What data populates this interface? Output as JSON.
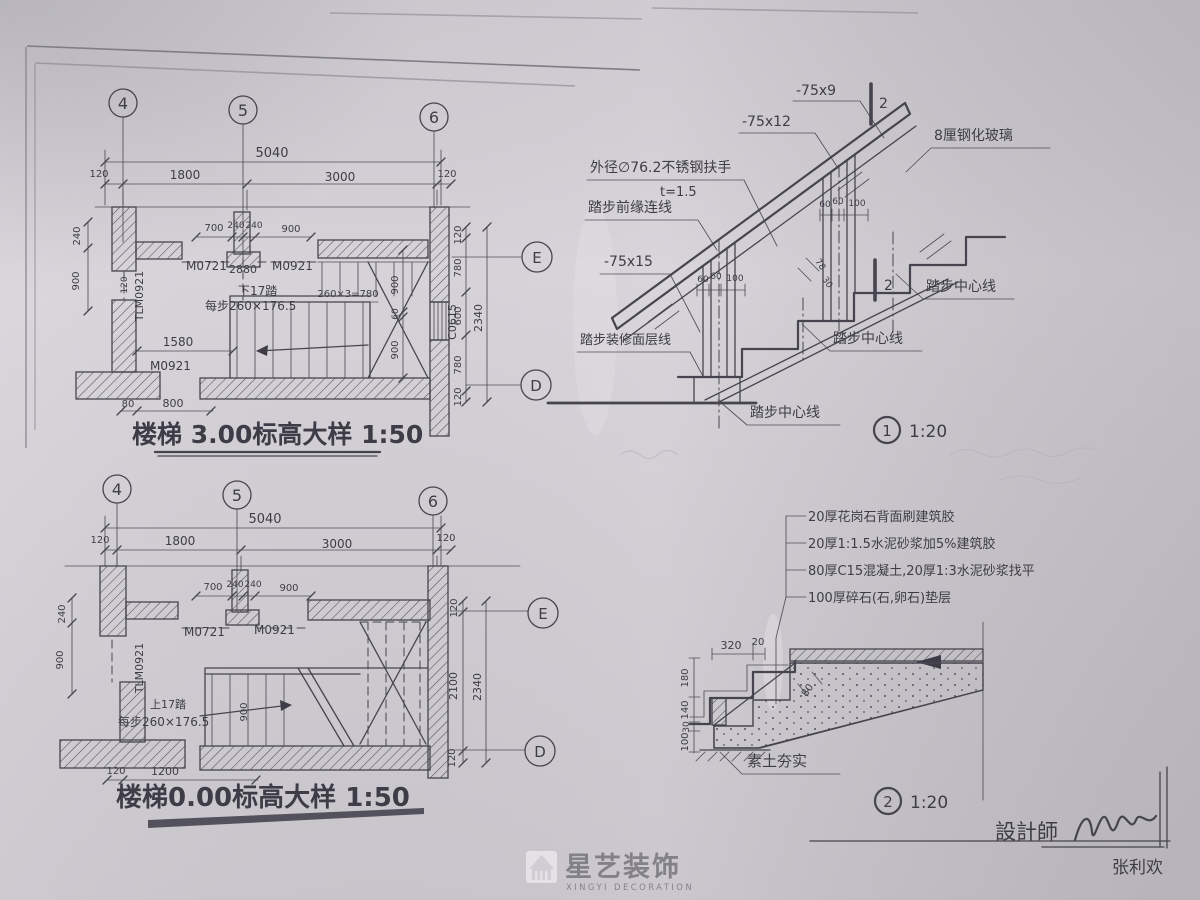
{
  "plan_top": {
    "title": "楼梯 3.00标高大样 1:50",
    "grid_cols": [
      "4",
      "5",
      "6"
    ],
    "grid_rows": [
      "E",
      "D"
    ],
    "dims": {
      "top": [
        "5040",
        "120",
        "1800",
        "3000",
        "120"
      ],
      "sub": [
        "700",
        "240",
        "240",
        "900"
      ],
      "left": [
        "240",
        "900"
      ],
      "right": [
        "120",
        "780",
        "600",
        "780",
        "120"
      ],
      "right_total": "2340",
      "inner": [
        "900",
        "60",
        "900"
      ],
      "run": "1580",
      "bottom": [
        "80",
        "800"
      ],
      "door_width": "2880",
      "tread_calc": "260×3=780",
      "tlm_offset": "120"
    },
    "labels": {
      "door_a": "M0721",
      "door_b": "M0921",
      "door_c": "M0921",
      "door_tlm": "TLM0921",
      "window": "C0615",
      "direction": "下17踏",
      "step_note": "每步260×176.5"
    }
  },
  "plan_bottom": {
    "title": "楼梯0.00标高大样 1:50",
    "grid_cols": [
      "4",
      "5",
      "6"
    ],
    "grid_rows": [
      "E",
      "D"
    ],
    "dims": {
      "top": [
        "5040",
        "120",
        "1800",
        "3000",
        "120"
      ],
      "sub": [
        "700",
        "240",
        "240",
        "900"
      ],
      "left": [
        "240",
        "900"
      ],
      "right": [
        "120",
        "2100",
        "120"
      ],
      "right_total": "2340",
      "bottom": [
        "120",
        "1200"
      ],
      "flight_width": "900"
    },
    "labels": {
      "door_a": "M0721",
      "door_b": "M0921",
      "door_tlm": "TLM0921",
      "direction": "上17踏",
      "step_note": "每步260×176.5"
    }
  },
  "detail_1": {
    "number": "1",
    "scale": "1:20",
    "labels": {
      "flat_bar_9": "-75x9",
      "flat_bar_12": "-75x12",
      "flat_bar_15": "-75x15",
      "handrail": "外径∅76.2不锈钢扶手",
      "handrail_t": "t=1.5",
      "glass": "8厘钢化玻璃",
      "nose_line": "踏步前缘连线",
      "finish_line": "踏步装修面层线",
      "center_line": "踏步中心线",
      "section_mark": "2"
    },
    "dims": {
      "a": "60",
      "b": "60",
      "c": "100",
      "d": "78",
      "e": "30"
    }
  },
  "detail_2": {
    "number": "2",
    "scale": "1:20",
    "notes": [
      "20厚花岗石背面刷建筑胶",
      "20厚1:1.5水泥砂浆加5%建筑胶",
      "80厚C15混凝土,20厚1:3水泥砂浆找平",
      "100厚碎石(石,卵石)垫层"
    ],
    "labels": {
      "soil": "素土夯实"
    },
    "dims": {
      "tread": "320",
      "nose": "20",
      "h1": "180",
      "h2": "140",
      "h3": "30",
      "h4": "100",
      "waist": "80"
    }
  },
  "title_block": {
    "designer_label": "設計師",
    "designer_name": "张利欢"
  },
  "watermark": {
    "cn": "星艺装饰",
    "en": "XINGYI DECORATION"
  }
}
